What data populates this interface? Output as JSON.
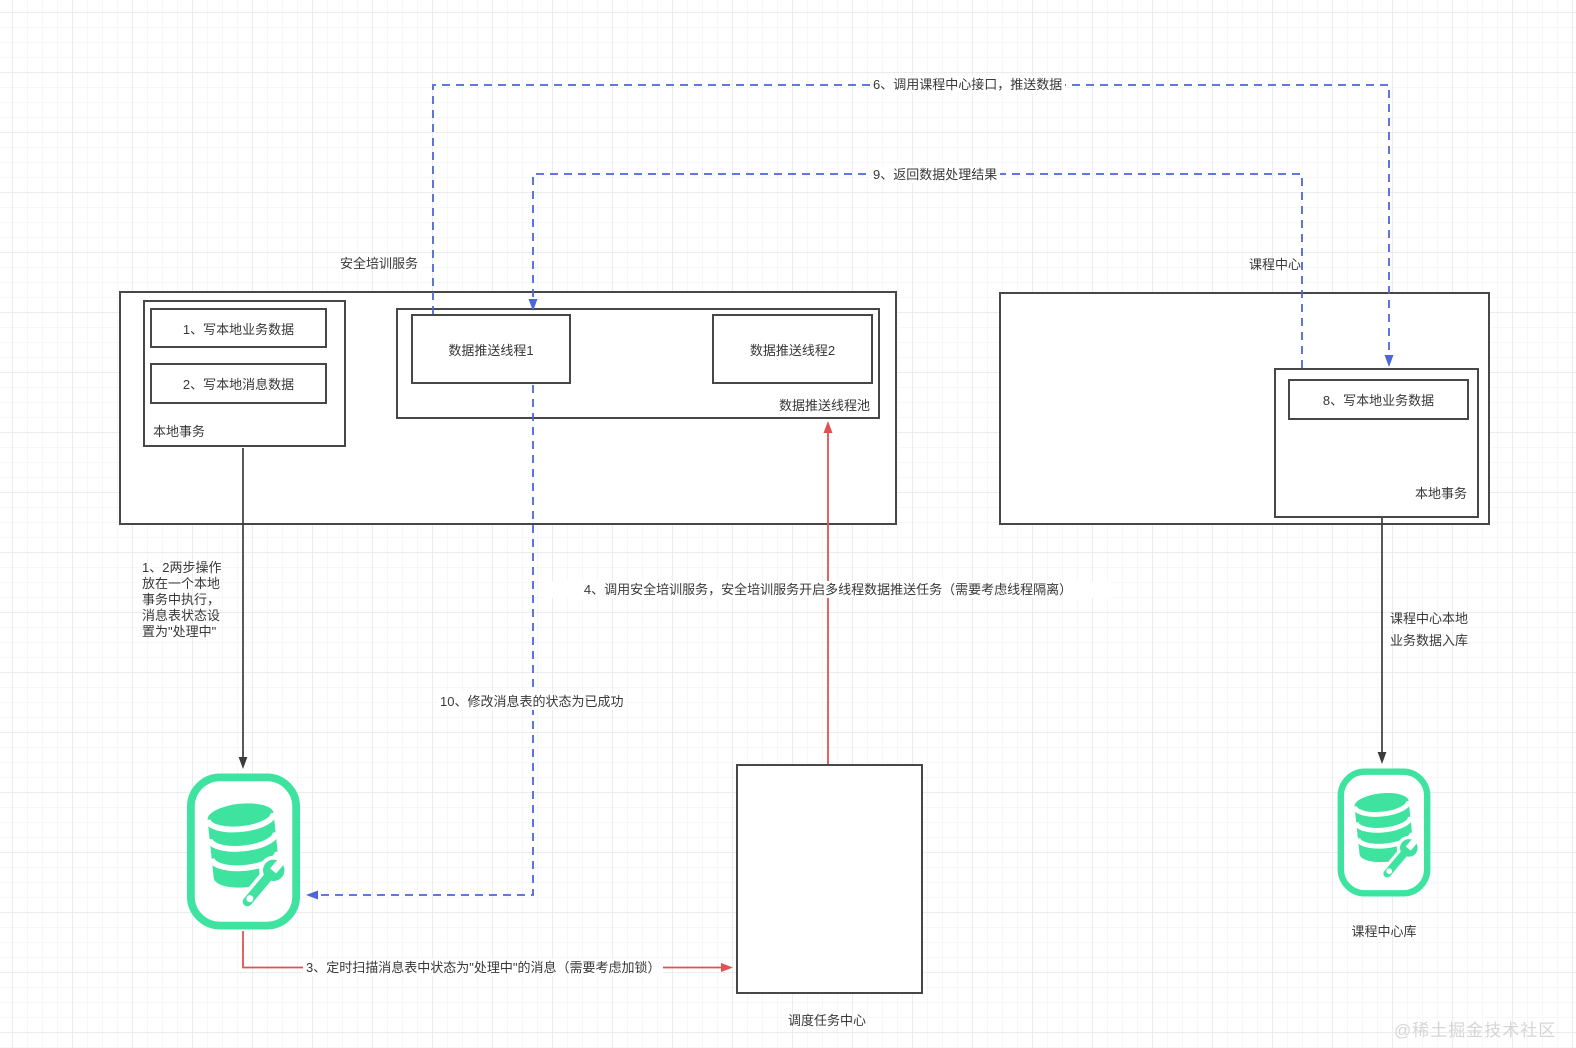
{
  "colors": {
    "connector_blue": "#4c66d9",
    "connector_red": "#e05252",
    "connector_black": "#3c3c3c",
    "icon_green": "#3ee3a0",
    "box_border": "#474747",
    "text": "#383838",
    "watermark": "#d6d6d6"
  },
  "services": {
    "security_training_label": "安全培训服务",
    "course_center_label": "课程中心"
  },
  "security_training": {
    "local_transaction_label": "本地事务",
    "step1_label": "1、写本地业务数据",
    "step2_label": "2、写本地消息数据",
    "thread_pool_label": "数据推送线程池",
    "thread1_label": "数据推送线程1",
    "thread2_label": "数据推送线程2"
  },
  "course_center": {
    "local_transaction_label": "本地事务",
    "step8_label": "8、写本地业务数据"
  },
  "scheduler": {
    "label": "调度任务中心"
  },
  "databases": {
    "message_db_icon": "database-wrench-icon",
    "course_db_icon": "database-wrench-icon",
    "course_db_label": "课程中心库"
  },
  "annotations": {
    "step1_2_note": "1、2两步操作\n放在一个本地\n事务中执行，\n消息表状态设\n置为\"处理中\"",
    "step3": "3、定时扫描消息表中状态为\"处理中\"的消息（需要考虑加锁）",
    "step4": "4、调用安全培训服务，安全培训服务开启多线程数据推送任务（需要考虑线程隔离）",
    "step6": "6、调用课程中心接口，推送数据",
    "step9": "9、返回数据处理结果",
    "step10": "10、修改消息表的状态为已成功",
    "course_db_inflow": "课程中心本地\n业务数据入库"
  },
  "watermark": "@稀土掘金技术社区"
}
